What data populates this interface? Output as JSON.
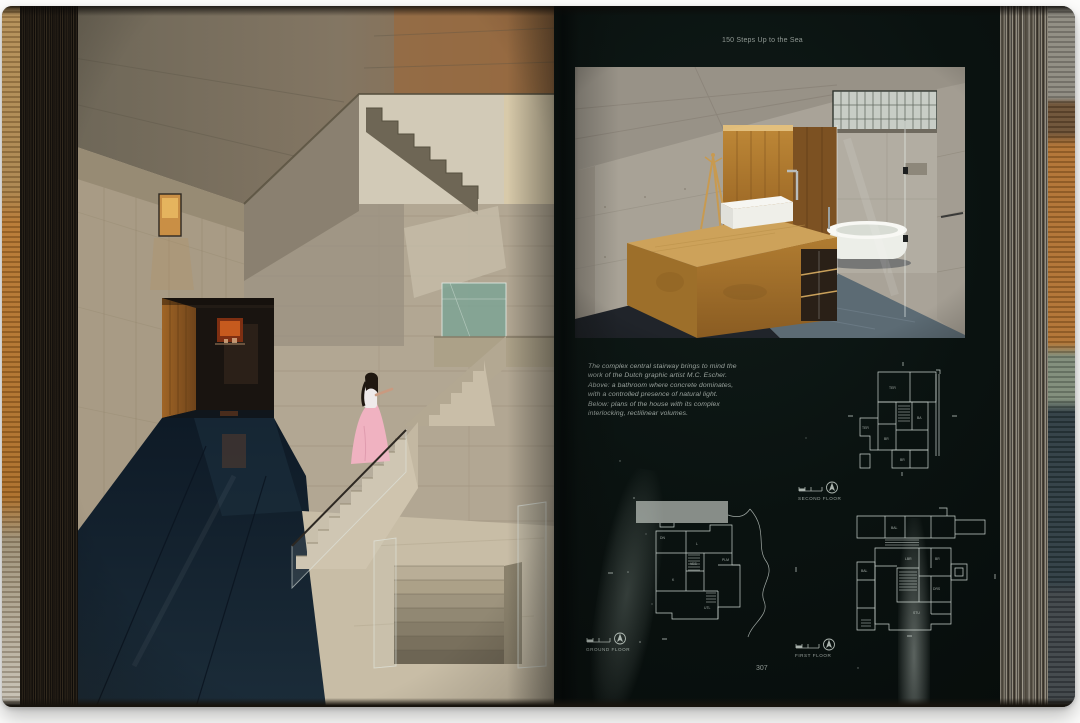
{
  "palette": {
    "background_white": "#fdfdfc",
    "page_black": "#0a1210",
    "text_grey": "#98a19c",
    "plan_line": "#c8d1cc",
    "concrete_light": "#b3a995",
    "wood_orange": "#b06f2a",
    "floor_navy": "#13202c",
    "dress_pink": "#f0b2c1",
    "glass_green": "#7ca394"
  },
  "right_page": {
    "header": "150 Steps Up to the Sea",
    "caption": "The complex central stairway brings to mind the\nwork of the Dutch graphic artist M.C. Escher.\nAbove: a bathroom where concrete dominates,\nwith a controlled presence of natural light.\nBelow: plans of the house with its complex\ninterlocking, rectilinear volumes.",
    "page_number": "307",
    "plans": {
      "second_floor": {
        "caption": "SECOND FLOOR",
        "labels": [
          "TER",
          "BR",
          "BA",
          "TER",
          "BR"
        ]
      },
      "ground_floor": {
        "caption": "GROUND FLOOR",
        "labels": [
          "DN",
          "L",
          "PLM",
          "VES",
          "K",
          "UTL"
        ]
      },
      "first_floor": {
        "caption": "FIRST FLOOR",
        "labels": [
          "BAL",
          "LBR",
          "BR",
          "DRS",
          "STU",
          "BAL"
        ]
      }
    }
  }
}
